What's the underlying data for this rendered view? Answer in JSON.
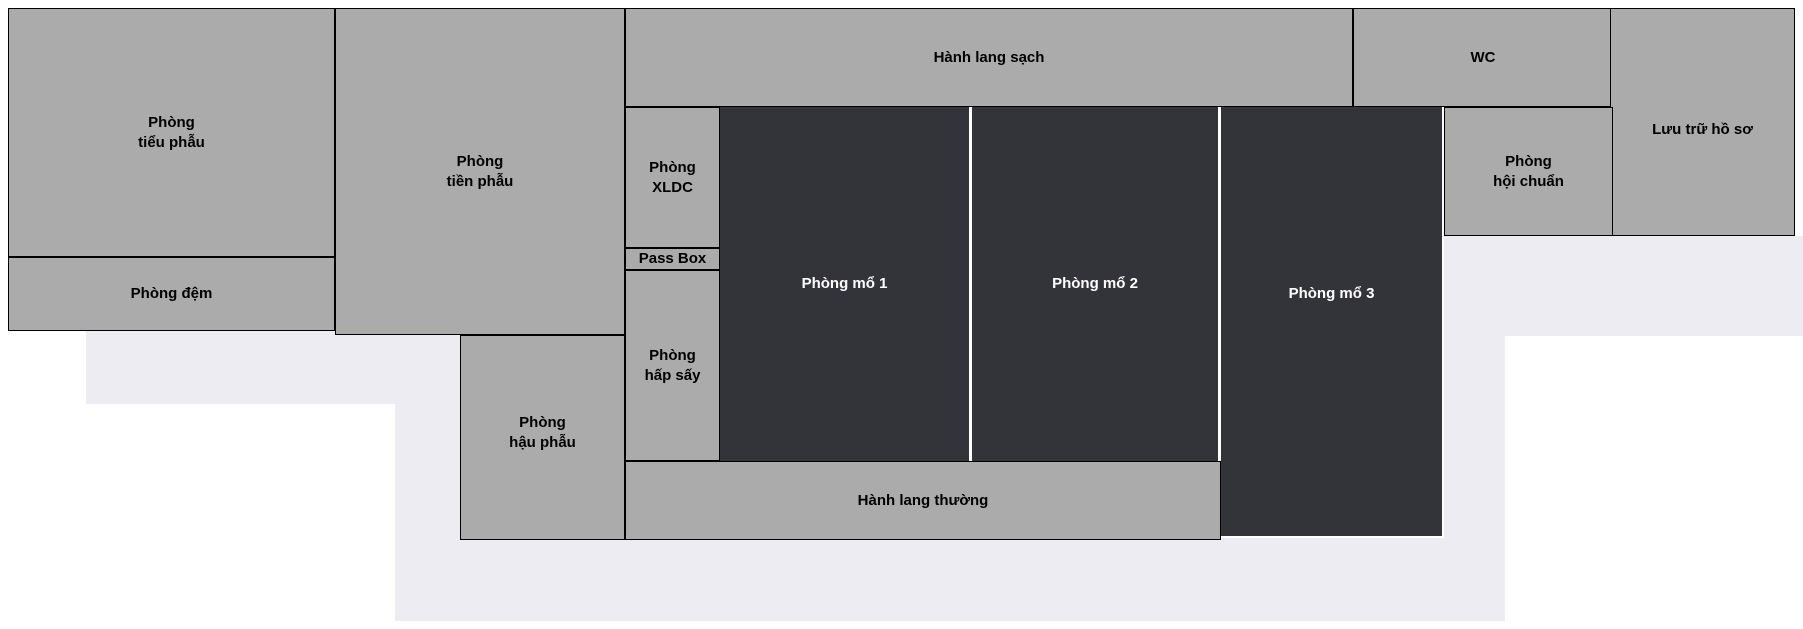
{
  "canvas": {
    "width": 1803,
    "height": 629
  },
  "colors": {
    "page_bg": "#ffffff",
    "room_fill": "#ababab",
    "room_border": "#000000",
    "room_text": "#000000",
    "operating_fill": "#33333a",
    "operating_text": "#ffffff",
    "backdrop_fill": "#ececf2",
    "divider": "#ffffff"
  },
  "backdrop_shapes": [
    {
      "x": 86,
      "y": 331,
      "w": 374,
      "h": 73
    },
    {
      "x": 395,
      "y": 404,
      "w": 1110,
      "h": 217
    },
    {
      "x": 1444,
      "y": 236,
      "w": 359,
      "h": 100
    },
    {
      "x": 1444,
      "y": 336,
      "w": 61,
      "h": 68
    }
  ],
  "rooms": [
    {
      "id": "phong-tieu-phau",
      "label": "Phòng\ntiểu phẫu",
      "type": "clean",
      "x": 8,
      "y": 8,
      "w": 327,
      "h": 249
    },
    {
      "id": "phong-dem",
      "label": "Phòng đệm",
      "type": "clean",
      "x": 8,
      "y": 257,
      "w": 327,
      "h": 74
    },
    {
      "id": "phong-tien-phau",
      "label": "Phòng\ntiền phẫu",
      "type": "clean",
      "x": 335,
      "y": 8,
      "w": 290,
      "h": 327
    },
    {
      "id": "phong-hau-phau",
      "label": "Phòng\nhậu phẫu",
      "type": "clean",
      "x": 460,
      "y": 335,
      "w": 165,
      "h": 205,
      "label_dy": -5
    },
    {
      "id": "hanh-lang-sach",
      "label": "Hành lang sạch",
      "type": "clean",
      "x": 625,
      "y": 8,
      "w": 728,
      "h": 99
    },
    {
      "id": "wc",
      "label": "WC",
      "type": "clean",
      "x": 1353,
      "y": 8,
      "w": 260,
      "h": 99
    },
    {
      "id": "luu-tru-ho-so",
      "label": "Lưu trữ hồ sơ",
      "type": "clean",
      "x": 1610,
      "y": 8,
      "w": 185,
      "h": 228,
      "label_dy": 8
    },
    {
      "id": "phong-hoi-chuan",
      "label": "Phòng\nhội chuẩn",
      "type": "clean",
      "x": 1444,
      "y": 107,
      "w": 169,
      "h": 129
    },
    {
      "id": "phong-xldc",
      "label": "Phòng\nXLDC",
      "type": "clean",
      "x": 625,
      "y": 107,
      "w": 95,
      "h": 141
    },
    {
      "id": "pass-box",
      "label": "Pass Box",
      "type": "clean",
      "x": 625,
      "y": 248,
      "w": 95,
      "h": 22
    },
    {
      "id": "phong-hap-say",
      "label": "Phòng\nhấp sấy",
      "type": "clean",
      "x": 625,
      "y": 270,
      "w": 95,
      "h": 191
    },
    {
      "id": "hanh-lang-thuong",
      "label": "Hành lang thường",
      "type": "clean",
      "x": 625,
      "y": 461,
      "w": 596,
      "h": 79
    },
    {
      "id": "phong-mo-1",
      "label": "Phòng mổ 1",
      "type": "operating",
      "x": 720,
      "y": 107,
      "w": 249,
      "h": 354
    },
    {
      "id": "phong-mo-2",
      "label": "Phòng mổ 2",
      "type": "operating",
      "x": 972,
      "y": 107,
      "w": 246,
      "h": 354
    },
    {
      "id": "phong-mo-3",
      "label": "Phòng mổ 3",
      "type": "operating",
      "x": 1221,
      "y": 107,
      "w": 223,
      "h": 431,
      "label_dy": -28,
      "white_edge": true
    }
  ],
  "dividers": [
    {
      "x": 969,
      "y": 107,
      "w": 3,
      "h": 354
    },
    {
      "x": 1218,
      "y": 107,
      "w": 3,
      "h": 354
    }
  ]
}
